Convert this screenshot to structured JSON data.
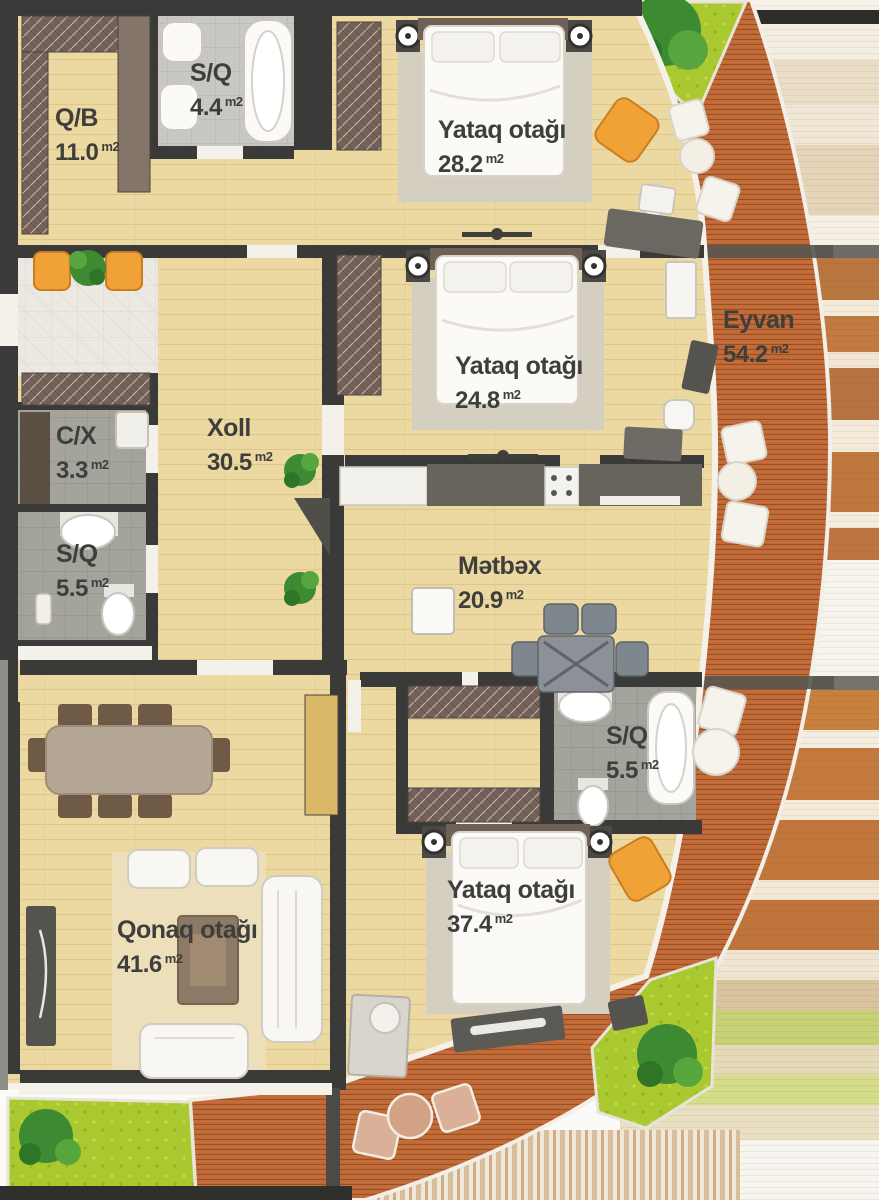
{
  "plan_title": "Apartment floor plan",
  "rooms": [
    {
      "id": "qb",
      "name": "Q/B",
      "area": "11.0",
      "unit": "m2"
    },
    {
      "id": "sq-top",
      "name": "S/Q",
      "area": "4.4",
      "unit": "m2"
    },
    {
      "id": "bedroom-top",
      "name": "Yataq otağı",
      "area": "28.2",
      "unit": "m2"
    },
    {
      "id": "bedroom-middle",
      "name": "Yataq otağı",
      "area": "24.8",
      "unit": "m2"
    },
    {
      "id": "eyvan",
      "name": "Eyvan",
      "area": "54.2",
      "unit": "m2"
    },
    {
      "id": "xoll",
      "name": "Xoll",
      "area": "30.5",
      "unit": "m2"
    },
    {
      "id": "cx",
      "name": "C/X",
      "area": "3.3",
      "unit": "m2"
    },
    {
      "id": "sq-left",
      "name": "S/Q",
      "area": "5.5",
      "unit": "m2"
    },
    {
      "id": "metbex",
      "name": "Mətbəx",
      "area": "20.9",
      "unit": "m2"
    },
    {
      "id": "qonaq",
      "name": "Qonaq otağı",
      "area": "41.6",
      "unit": "m2"
    },
    {
      "id": "sq-bottom",
      "name": "S/Q",
      "area": "5.5",
      "unit": "m2"
    },
    {
      "id": "bedroom-bottom",
      "name": "Yataq otağı",
      "area": "37.4",
      "unit": "m2"
    }
  ],
  "colors": {
    "wall": "#3a3a38",
    "floor": "#ecd9a2",
    "deck": "#c46c39",
    "deckline": "#8f4c24",
    "grass": "#aac82f",
    "tree": "#3c8a31",
    "accent": "#f0a236",
    "text": "#3e3e3b",
    "white": "#f6f3ec"
  }
}
